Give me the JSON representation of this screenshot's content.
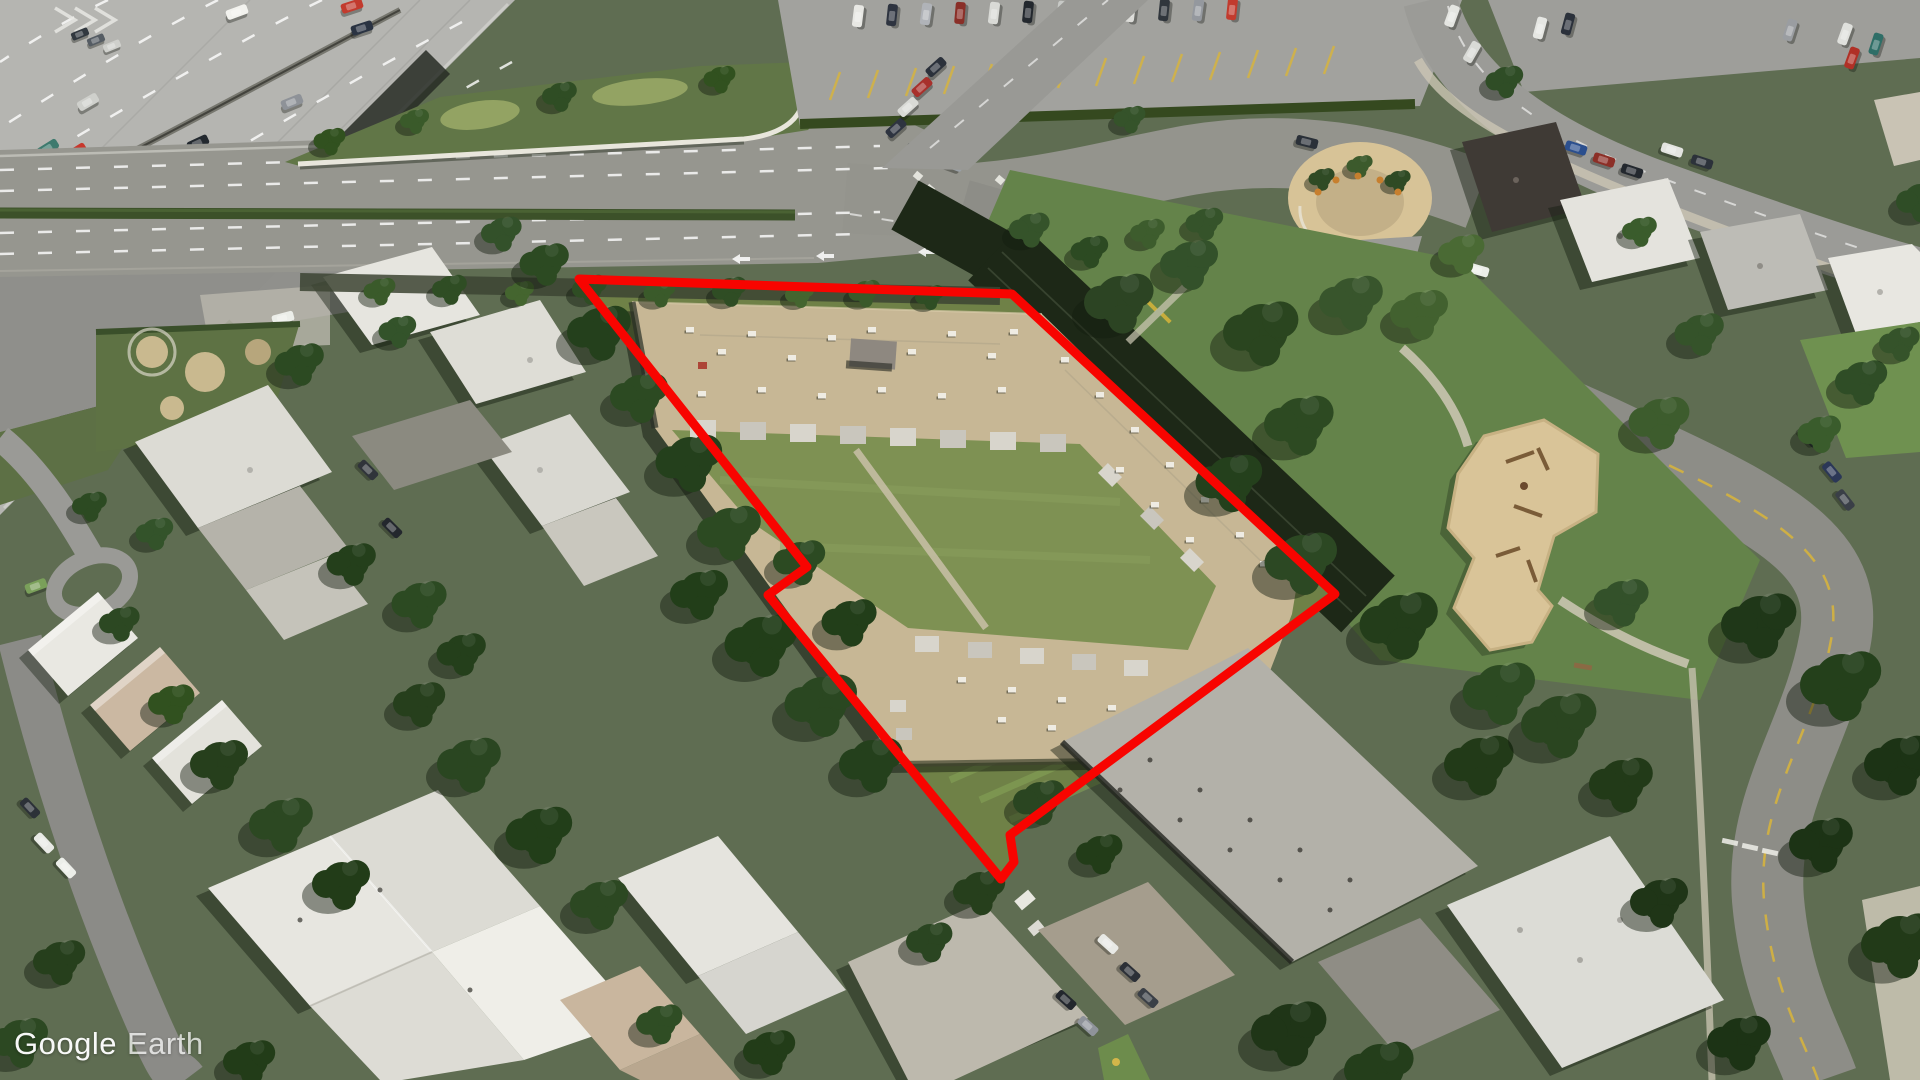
{
  "app": {
    "watermark": {
      "brand": "Google",
      "product": "Earth",
      "color": "#ffffff"
    }
  },
  "view": {
    "type": "aerial-oblique-satellite-imagery",
    "width_px": 1920,
    "height_px": 1080
  },
  "annotation": {
    "property_outline": {
      "shape": "closed-polygon",
      "color": "#f80400",
      "stroke_width": 9,
      "points": "579,279 1012,294 1335,594 1010,835 1014,862 1001,879 768,595 807,567"
    }
  },
  "scene": {
    "landmarks": [
      {
        "name": "elevated-highway",
        "position": "top-left"
      },
      {
        "name": "boulevard-with-hedge-median",
        "position": "upper-center"
      },
      {
        "name": "signalized-intersection-with-crosswalks",
        "position": "upper-right-of-center"
      },
      {
        "name": "surface-parking-lots",
        "position": "top-right"
      },
      {
        "name": "commercial-flat-roof-buildings",
        "position": "top-right"
      },
      {
        "name": "horseshoe-garden-plaza",
        "position": "right-of-intersection"
      },
      {
        "name": "rail-corridor-in-shadow",
        "position": "northeast-of-outlined-property"
      },
      {
        "name": "park-with-playground",
        "position": "center-right"
      },
      {
        "name": "outlined-courtyard-apartment-complex",
        "position": "center",
        "roof_color": "#c7b795"
      },
      {
        "name": "residential-rowhouse-blocks",
        "position": "left-and-bottom-left"
      },
      {
        "name": "apartment-slab-buildings",
        "position": "bottom-center-and-bottom-right"
      }
    ],
    "palette": {
      "road": "#96968f",
      "highway_deck": "#b5b5b1",
      "tree_dark": "#243a1c",
      "lawn": "#6f8147",
      "playground_sand": "#d9c498",
      "roof_white": "#e7e6e0",
      "roof_tan": "#c7b795",
      "lane_marking": "#ffffff",
      "parking_stall_marking": "#d9b53a"
    }
  }
}
